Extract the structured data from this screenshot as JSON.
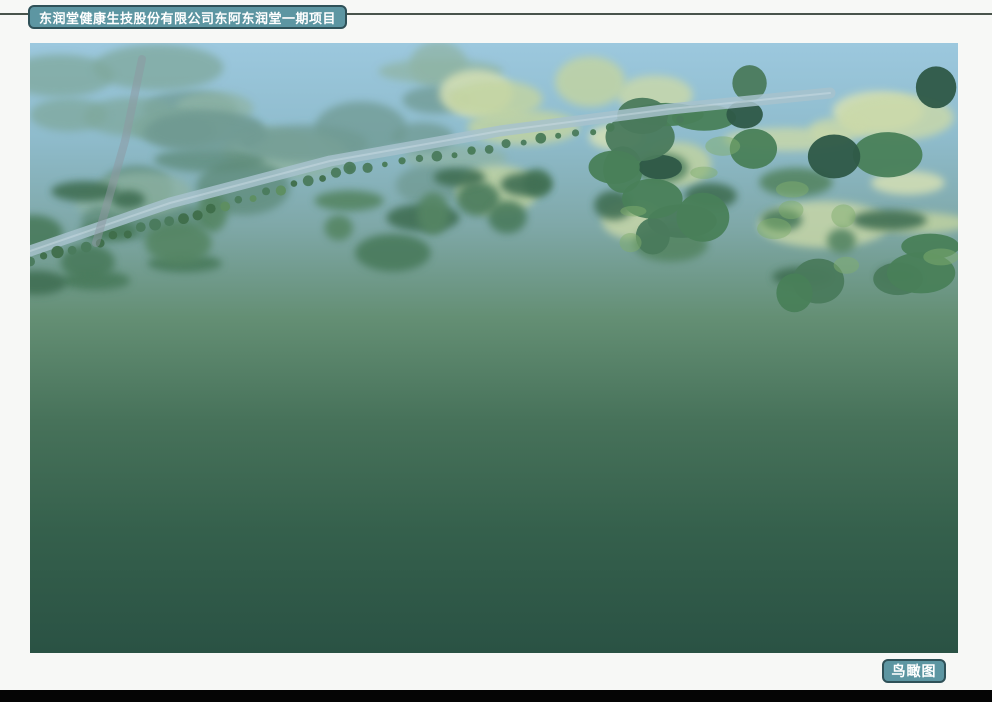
{
  "header": {
    "title": "东润堂健康生技股份有限公司东阿东润堂一期项目",
    "badge_bg": "#5d96a2",
    "badge_border": "#2f5158",
    "text_color": "#ffffff",
    "divider_color": "#49544c"
  },
  "footer": {
    "label": "鸟瞰图",
    "badge_bg": "#5d96a2",
    "badge_border": "#2f5158",
    "text_color": "#ffffff",
    "bottom_bar_color": "#050505"
  },
  "rendering": {
    "kind": "architectural aerial rendering (bird's-eye view) of a factory campus",
    "palette": {
      "sky_top": "#9cc8de",
      "haze_mid": "#7fa8a8",
      "canopy_far": "#6f9a92",
      "canopy_mid": "#4a7a5c",
      "canopy_dark": "#2e5947",
      "canopy_deep": "#20453a",
      "canopy_light": "#5e8e60",
      "moss": "#7fae6d",
      "meadow": "#c3d4a0",
      "meadow_light": "#d9e2b4",
      "river": "#a7c2cc",
      "road": "#79838f",
      "road_light": "#8d98a2",
      "sidewalk": "#9aa4ad",
      "campus": "#8d99a4",
      "roof_far": "#c9d2da",
      "roof_near": "#aeb9c3",
      "ridge": "#e9eef3",
      "wall_end": "#d9d6ab",
      "wall_front": "#cdcfb2",
      "vent_blue": "#4f7ec2",
      "glass_dark": "#3d4b56",
      "glass_frame": "#c6d0d8",
      "skylight": "#4a7ac0",
      "skylight_hi": "#86aede",
      "canopy_white": "#e3e7ea",
      "plaza": "#a2adb6",
      "pond": "#6ec2d2",
      "sand": "#d8cba2",
      "grass": "#567f50",
      "truck_red": "#c23227",
      "trailer": "#e9ebec",
      "bus_blue": "#2e6fad",
      "marking": "#e8edf1"
    }
  }
}
